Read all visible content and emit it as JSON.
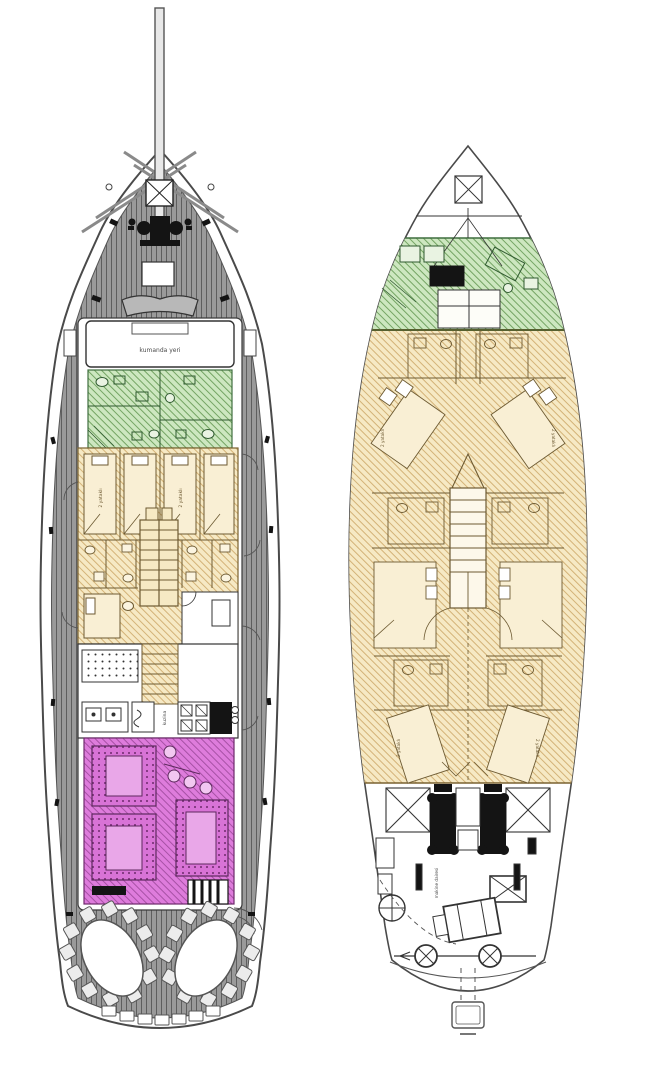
{
  "document": {
    "type": "yacht-deck-plan-drawing",
    "boats_shown": 2
  },
  "colors": {
    "background": "#ffffff",
    "deck_gray": "#999999",
    "plank_line": "#5e5e5e",
    "hull_outline": "#4a4a4a",
    "crew_area_green": "#cde7c0",
    "green_hatch_line": "#74a463",
    "cabin_area_yellow": "#f6e9c4",
    "yellow_hatch_line": "#cfac6e",
    "salon_magenta": "#de7cdc",
    "magenta_hatch_line": "#a751a5",
    "wall_line_brown": "#6d5a32",
    "machinery_black": "#141414"
  },
  "left_boat": {
    "wheelhouse_label": "kumanda yeri",
    "cabin_labels": [
      "2 yataklı",
      "2 yataklı"
    ],
    "galley_label": "kuzina"
  },
  "right_boat": {
    "cabin_labels": [
      "2 yataklı",
      "2 yataklı",
      "2 yataklı",
      "2 yataklı"
    ],
    "engine_room_label": "makine dairesi"
  }
}
